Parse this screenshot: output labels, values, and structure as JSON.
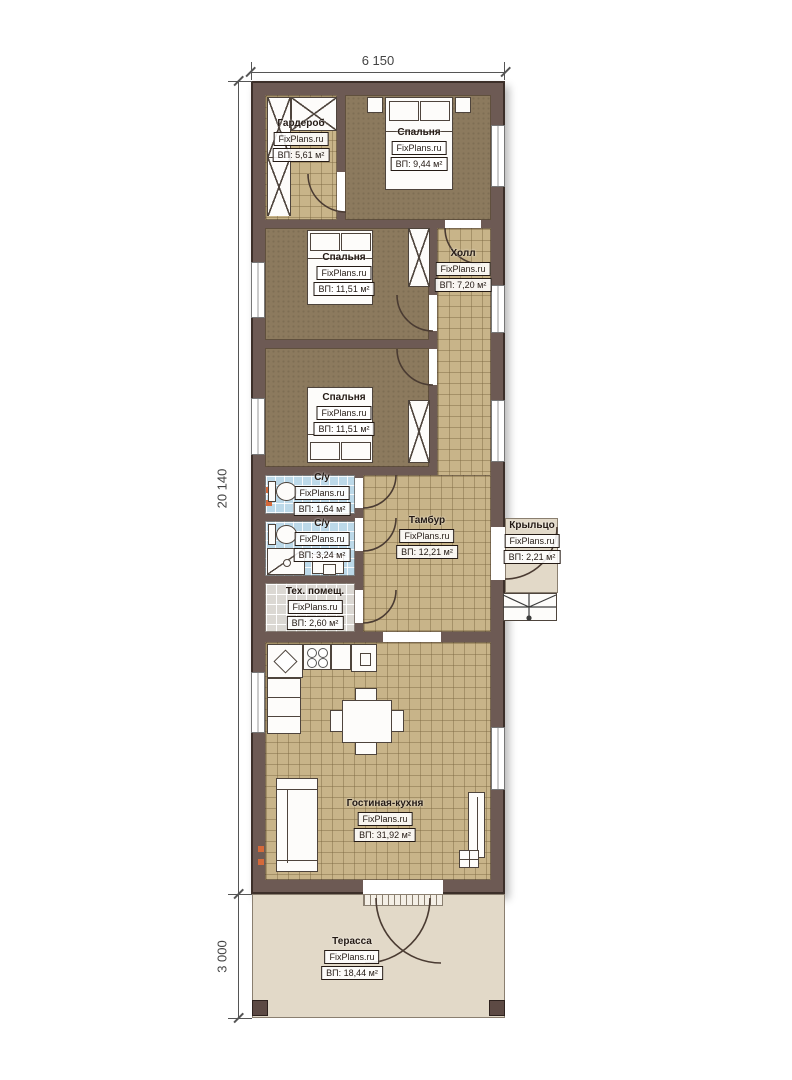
{
  "brand": "FixPlans.ru",
  "dimensions": {
    "building_width": "6 150",
    "building_length": "20 140",
    "terrace_depth": "3 000"
  },
  "rooms": [
    {
      "name": "Гардероб",
      "area": "ВП: 5,61 м²"
    },
    {
      "name": "Спальня",
      "area": "ВП: 9,44 м²"
    },
    {
      "name": "Спальня",
      "area": "ВП: 11,51 м²"
    },
    {
      "name": "Холл",
      "area": "ВП: 7,20 м²"
    },
    {
      "name": "Спальня",
      "area": "ВП: 11,51 м²"
    },
    {
      "name": "С/у",
      "area": "ВП: 1,64 м²"
    },
    {
      "name": "С/у",
      "area": "ВП: 3,24 м²"
    },
    {
      "name": "Тамбур",
      "area": "ВП: 12,21 м²"
    },
    {
      "name": "Крыльцо",
      "area": "ВП: 2,21 м²"
    },
    {
      "name": "Тех. помещ.",
      "area": "ВП: 2,60 м²"
    },
    {
      "name": "Гостиная-кухня",
      "area": "ВП: 31,92 м²"
    },
    {
      "name": "Терасса",
      "area": "ВП: 18,44 м²"
    }
  ],
  "colors": {
    "wall": "#6d5a54",
    "tile_floor": "#c8b489",
    "carpet_floor": "#8c7a5e",
    "bathroom_floor": "#bcd9e9",
    "tech_floor": "#dbd8d3",
    "terrace_floor": "#e2d9c8",
    "accent_marker": "#d4693a"
  }
}
